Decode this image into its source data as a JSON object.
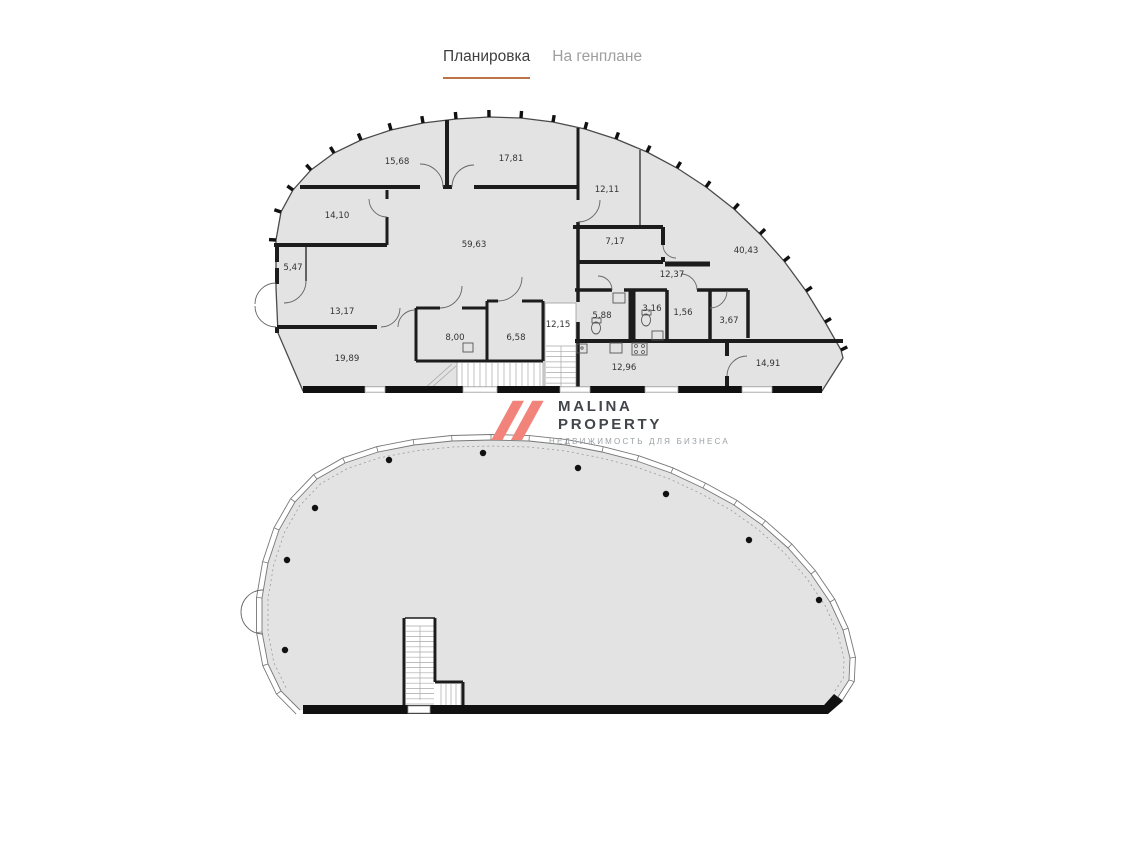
{
  "tabs": {
    "items": [
      {
        "label": "Планировка",
        "active": true
      },
      {
        "label": "На генплане",
        "active": false
      }
    ]
  },
  "logo": {
    "name_line1": "MALINA",
    "name_line2": "PROPERTY",
    "tagline": "НЕДВИЖИМОСТЬ ДЛЯ БИЗНЕСА",
    "icon_color": "#f2837b"
  },
  "colors": {
    "accent": "#bd7247",
    "floor_fill": "#e3e3e3",
    "wall": "#1c1c1c",
    "active_tab": "#3f3f3f",
    "inactive_tab": "#9e9e9e"
  },
  "floor_plans": [
    {
      "id": "upper-plan",
      "rooms": [
        {
          "label": "15,68",
          "x": 397,
          "y": 164
        },
        {
          "label": "17,81",
          "x": 511,
          "y": 161
        },
        {
          "label": "12,11",
          "x": 607,
          "y": 192
        },
        {
          "label": "14,10",
          "x": 337,
          "y": 218
        },
        {
          "label": "59,63",
          "x": 474,
          "y": 247
        },
        {
          "label": "7,17",
          "x": 615,
          "y": 244
        },
        {
          "label": "40,43",
          "x": 746,
          "y": 253
        },
        {
          "label": "12,37",
          "x": 672,
          "y": 277
        },
        {
          "label": "5,47",
          "x": 293,
          "y": 270
        },
        {
          "label": "13,17",
          "x": 342,
          "y": 314
        },
        {
          "label": "19,89",
          "x": 347,
          "y": 361
        },
        {
          "label": "8,00",
          "x": 455,
          "y": 340
        },
        {
          "label": "6,58",
          "x": 516,
          "y": 340
        },
        {
          "label": "12,15",
          "x": 558,
          "y": 327
        },
        {
          "label": "5,88",
          "x": 602,
          "y": 318
        },
        {
          "label": "3,16",
          "x": 652,
          "y": 311
        },
        {
          "label": "1,56",
          "x": 683,
          "y": 315
        },
        {
          "label": "3,67",
          "x": 729,
          "y": 323
        },
        {
          "label": "12,96",
          "x": 624,
          "y": 370
        },
        {
          "label": "14,91",
          "x": 768,
          "y": 366
        }
      ]
    },
    {
      "id": "lower-plan",
      "rooms": [],
      "columns": [
        [
          285,
          650
        ],
        [
          287,
          560
        ],
        [
          315,
          508
        ],
        [
          389,
          460
        ],
        [
          483,
          453
        ],
        [
          578,
          468
        ],
        [
          666,
          494
        ],
        [
          749,
          540
        ],
        [
          819,
          600
        ]
      ]
    }
  ]
}
